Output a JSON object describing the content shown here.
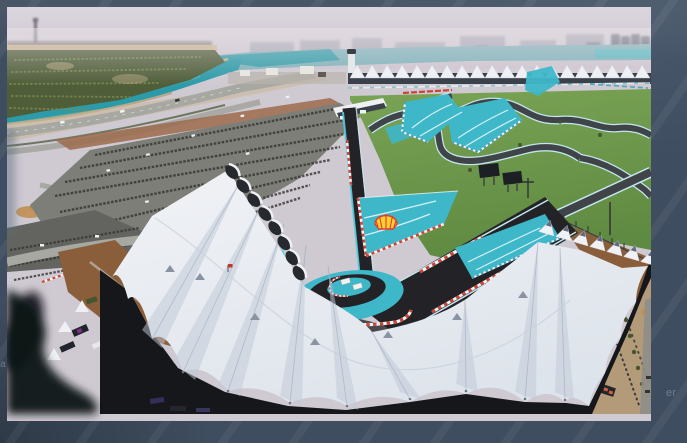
{
  "meta": {
    "subject": "Aerial photograph of the Yas Marina Formula 1 circuit in Abu Dhabi: hairpin complex with Shell logo painted on teal run-off, white tensile-fabric grandstand roofs, canal, mangrove plantation, parking lots and hazy city skyline",
    "brand_mark": "Shell"
  },
  "frame": {
    "remnant_left": "a",
    "remnant_right": "er"
  },
  "palette": {
    "frame_bg": "#3e4d5f",
    "frame_text": "#a9bac9",
    "sky_top": "#dbd5de",
    "sky_horizon": "#cdc5cf",
    "skyline": "#9b9cae",
    "skyline_dark": "#5b6273",
    "industry": "#6e6260",
    "tower_gray": "#6a6572",
    "water_far": "#7fb2ba",
    "water_canal": "#2b9aa9",
    "water_light": "#52bac4",
    "sand": "#ccb68e",
    "sand_dark": "#b69c73",
    "plantation": "#4f5d39",
    "plantation_dot": "#7a8a52",
    "road": "#a8a8a3",
    "road_dark": "#8e8e89",
    "parking": "#7e7e79",
    "parking_dark": "#63645f",
    "car_dark": "#33342f",
    "car_white": "#f2f2ef",
    "apron": "#9c6b4c",
    "canopy_white": "#eef0f4",
    "canopy_under": "#3a414b",
    "grass": "#7aa355",
    "grass_dark": "#5f8a41",
    "track": "#404449",
    "track_near": "#232327",
    "track_edge": "#c2e6ee",
    "barrier_cyan": "#56cede",
    "runoff": "#3eb7c9",
    "runoff_stripe": "#e8f7f8",
    "curb_red": "#cf4236",
    "curb_white": "#f4f4f2",
    "curb_blue": "#3f9dbd",
    "screen_dark": "#1c1f23",
    "roof_white": "#eff1f5",
    "roof_low": "#dde3eb",
    "roof_shade": "#c0c9d7",
    "roof_deep": "#93a0b3",
    "roof_dark": "#15171b",
    "seats": "#26292e",
    "cable": "#97a0ad",
    "vent": "#8a93a2",
    "vent_dark": "#5f6b7d",
    "dirt": "#8a5e3a",
    "dirt_light": "#c28b4a",
    "plaza": "#b39a79",
    "tree_autumn": "#c0914f",
    "hedge": "#44562f",
    "people": "#2e3138",
    "accent_orange": "#d2603b",
    "accent_purple": "#7b2f86",
    "shell_yellow": "#ffd02e",
    "shell_red": "#e23b2e",
    "red_flag": "#c5372c",
    "blur_dark": "#121316"
  }
}
